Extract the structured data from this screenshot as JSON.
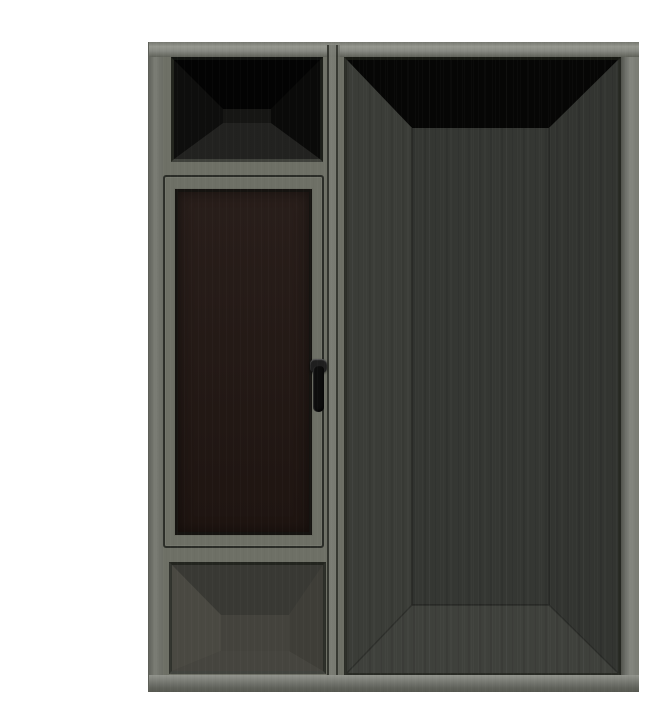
{
  "scene": {
    "background_color": "#ffffff",
    "frame_color": "#6e7066",
    "head_highlight_color": "#96988f",
    "sill_highlight_color": "#92948d",
    "chamfer_color": "#23251f",
    "groove_color": "#2b2d28",
    "transom_opening": {
      "ceiling": "#030303",
      "left_wall": "#0e0e0d",
      "right_wall": "#0a0a09",
      "back_wall": "#161614",
      "floor": "#222220"
    },
    "casement": {
      "glass_color": "#221713",
      "handle_lever_color": "#0d0d0d",
      "handle_mount_color": "#1f1f1f"
    },
    "bottom_opening": {
      "ceiling": "#393934",
      "left_wall": "#4a4942",
      "right_wall": "#3f3e38",
      "back_wall": "#44433d",
      "floor": "#46453f"
    },
    "door_opening": {
      "ceiling": "#060605",
      "left_wall": "#3b3d38",
      "right_wall": "#333531",
      "back_wall": "#353733",
      "floor": "#3f413c"
    }
  }
}
